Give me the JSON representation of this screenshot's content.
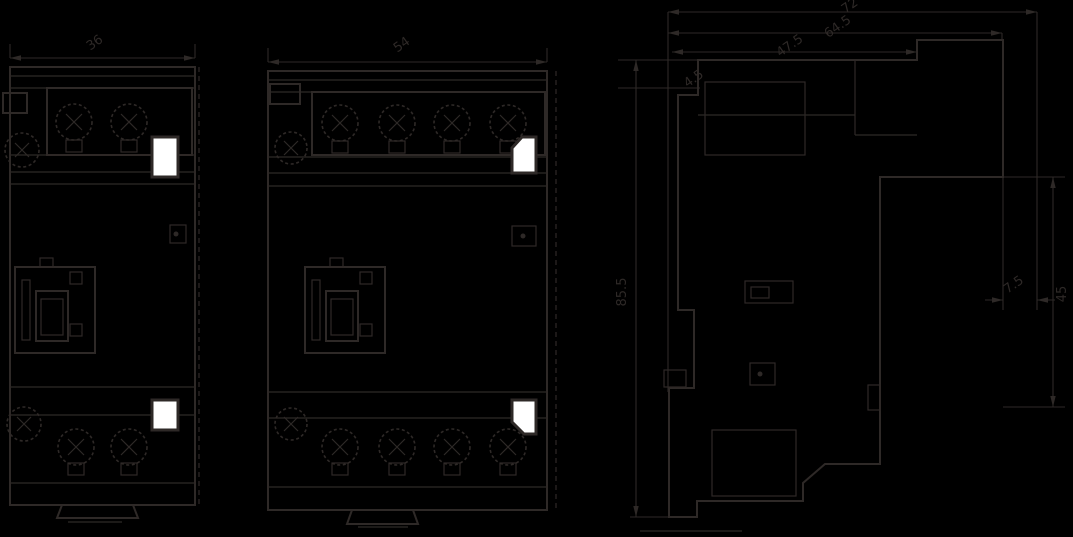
{
  "title": "modular-contactor-outline-dimension-drawing",
  "colors": {
    "background": "#000000",
    "line": "#2e2927",
    "window": "#ffffff"
  },
  "dimensions": {
    "front_2pole_width": "36",
    "front_4pole_width": "54",
    "side_total_depth": "72",
    "side_body_depth": "64.5",
    "side_front_depth": "47.5",
    "side_front_lip": "4.5",
    "side_height": "85.5",
    "side_din_step": "7.5",
    "side_din_recess": "45"
  }
}
